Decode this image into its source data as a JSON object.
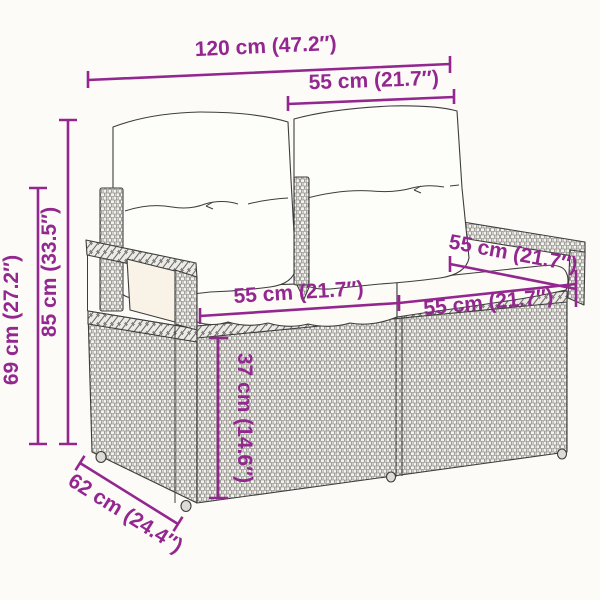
{
  "colors": {
    "dimension": "#93278f",
    "outline": "#3d3d3d",
    "background": "#fcfbf8"
  },
  "dimensions": {
    "overall_width": "120 cm (47.2″)",
    "back_cushion_width": "55 cm (21.7″)",
    "total_height": "85 cm (33.5″)",
    "side_height": "69 cm (27.2″)",
    "left_seat_width": "55 cm (21.7″)",
    "right_seat_width": "55 cm (21.7″)",
    "seat_depth": "55 cm (21.7″)",
    "seat_height": "37 cm (14.6″)",
    "base_depth": "62 cm (24.4″)"
  }
}
